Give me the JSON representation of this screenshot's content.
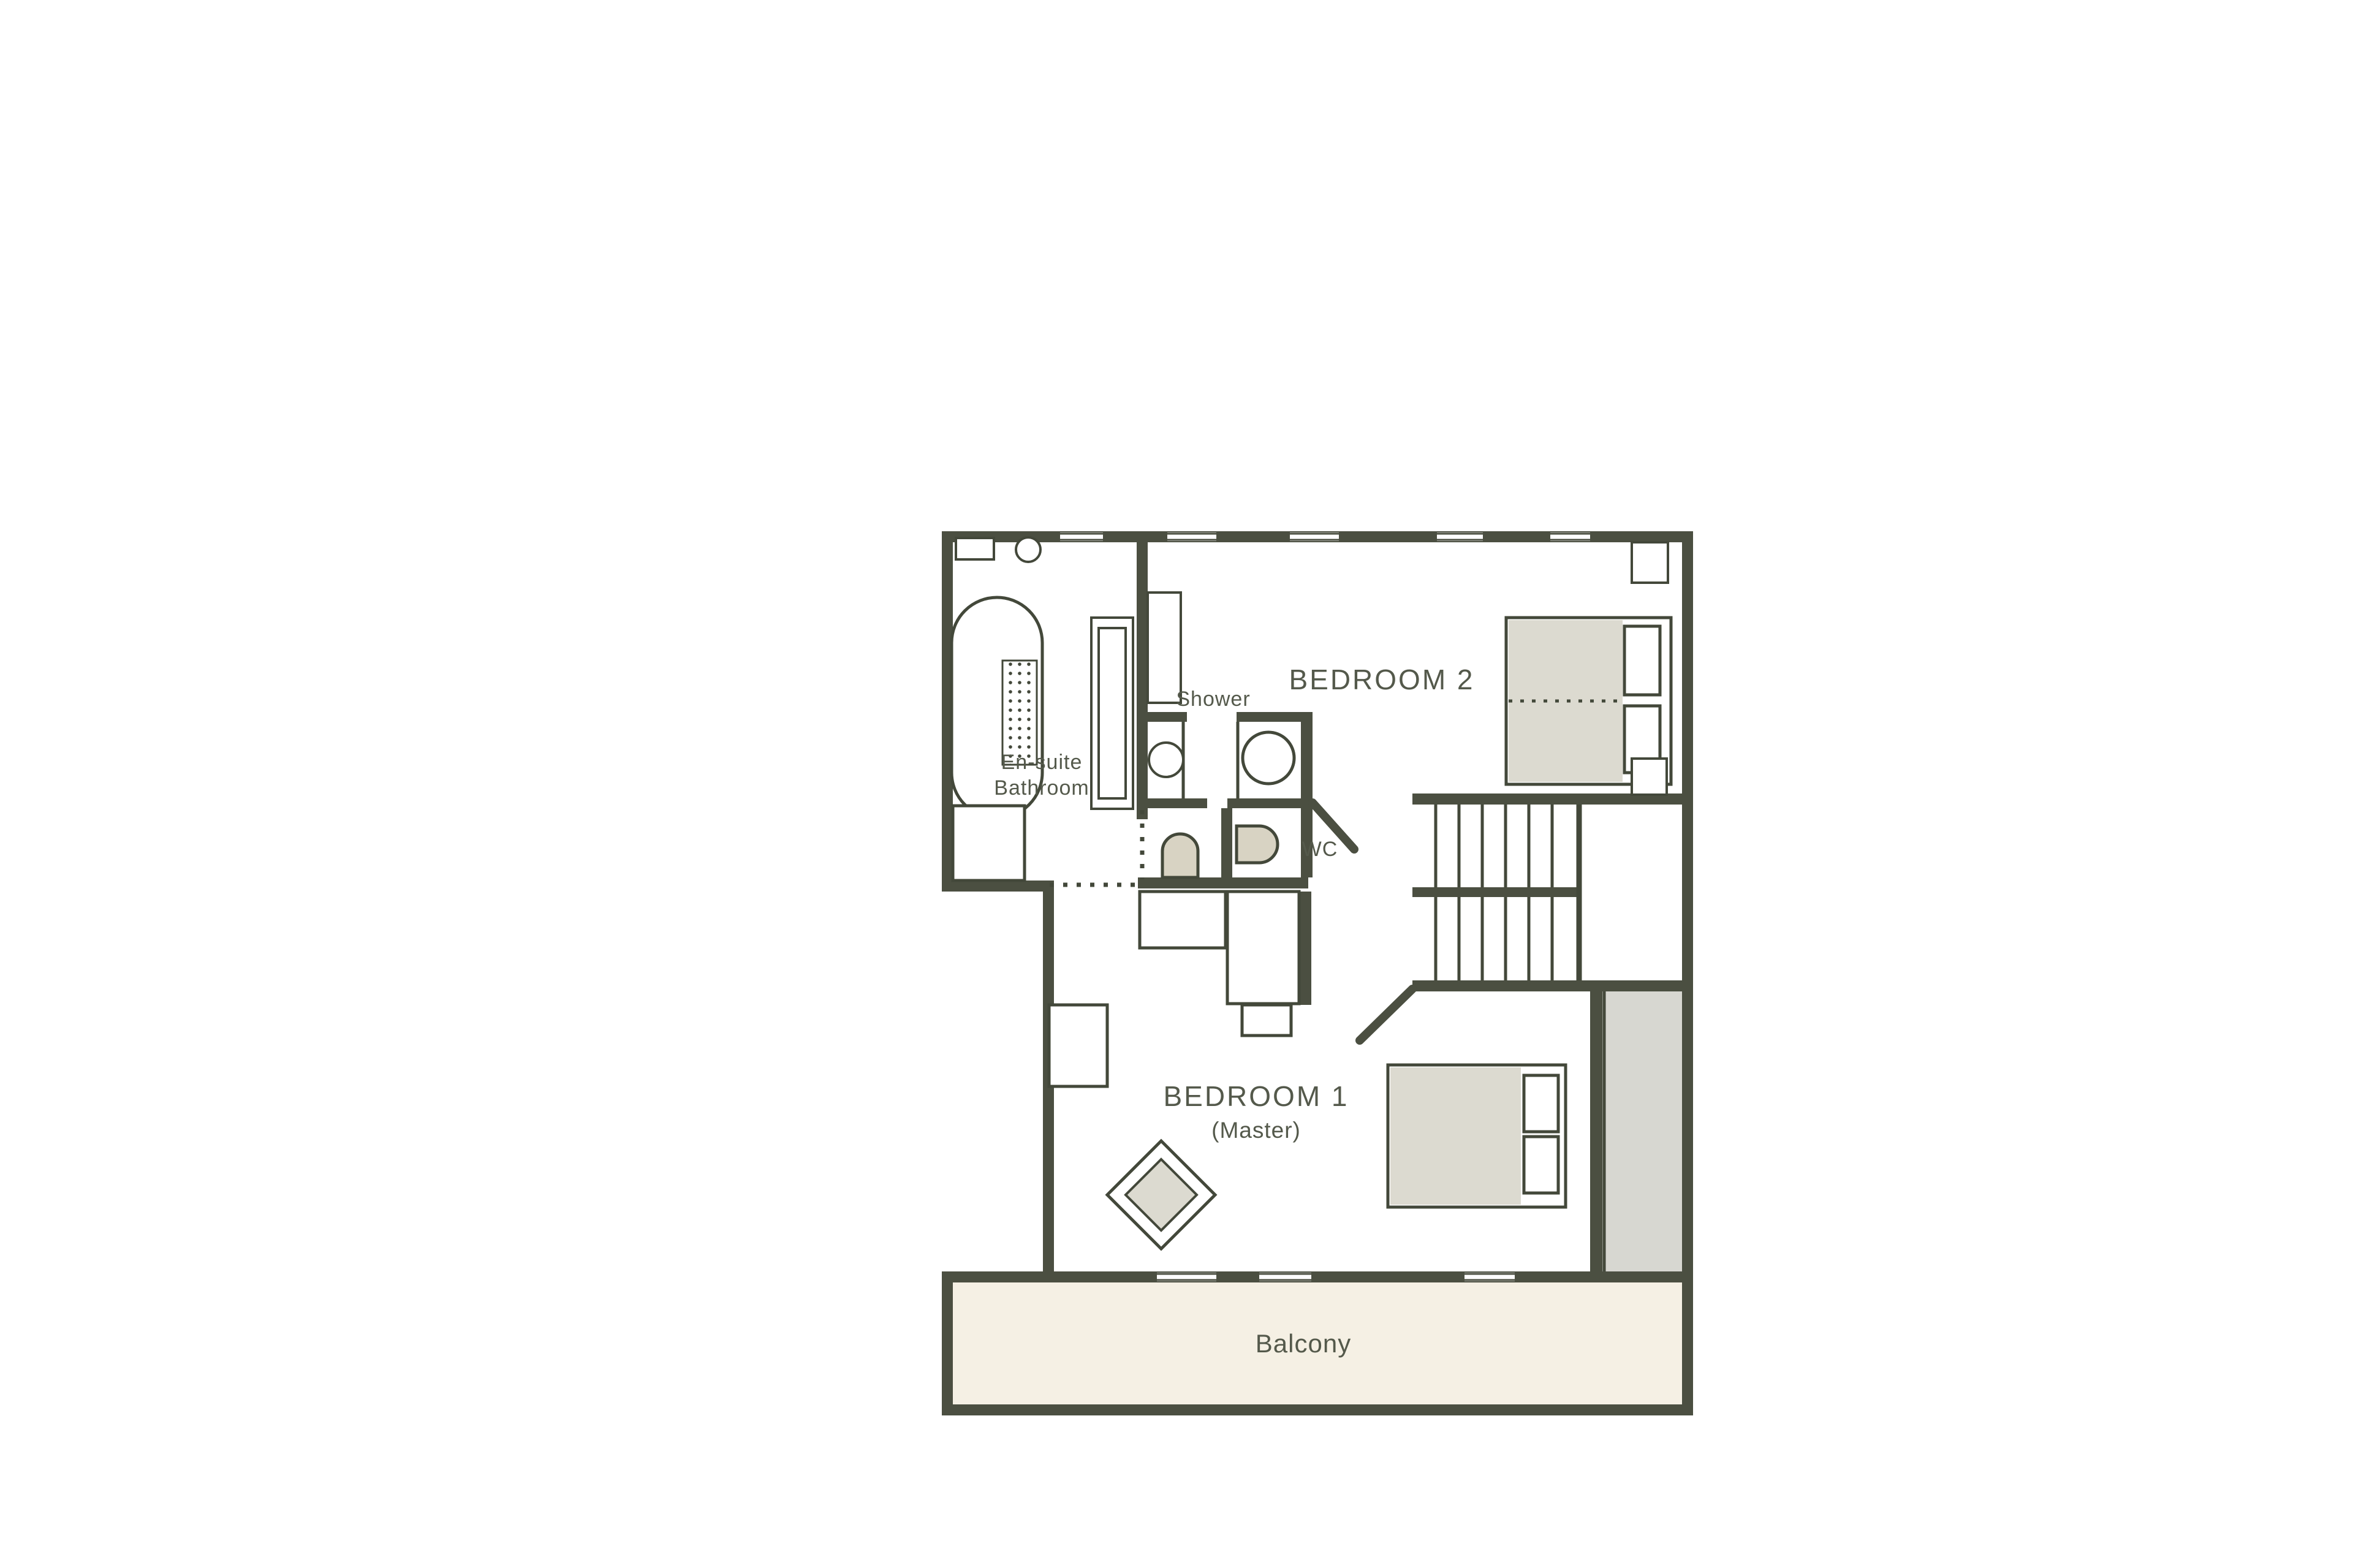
{
  "figure": {
    "type": "floor-plan",
    "description": "Hand-drawn style first-floor apartment plan with two bedrooms, en-suite bathroom, shower room, WC, staircase and balcony"
  },
  "rooms": {
    "bedroom2": {
      "label": "BEDROOM 2"
    },
    "bedroom1": {
      "line1": "BEDROOM 1",
      "line2": "(Master)"
    },
    "ensuite": {
      "line1": "En-suite",
      "line2": "Bathroom"
    },
    "shower": {
      "label": "Shower"
    },
    "wc": {
      "label": "WC"
    },
    "balcony": {
      "label": "Balcony"
    }
  },
  "fixtures": [
    "bathtub",
    "bath-mat",
    "washbasin-counter",
    "round-basin",
    "tall-cabinet",
    "shower-tray",
    "shower-stall-left",
    "shower-stall-right",
    "toilet-front",
    "toilet-side",
    "double-bed-bedroom2",
    "bedside-table-top",
    "bedside-table-bottom",
    "double-bed-bedroom1",
    "wardrobe",
    "dresser",
    "desk",
    "dressing-unit",
    "stool",
    "rug",
    "staircase",
    "door-swing-landing",
    "door-swing-bedroom1"
  ],
  "palette": {
    "wall": "#4b4f41",
    "outline": "#43483a",
    "text": "#54594b",
    "furniture_gray": "#dcdad0",
    "toilet_beige": "#d8d3c3",
    "balcony_cream": "#f5f0e4",
    "background": "#ffffff"
  }
}
